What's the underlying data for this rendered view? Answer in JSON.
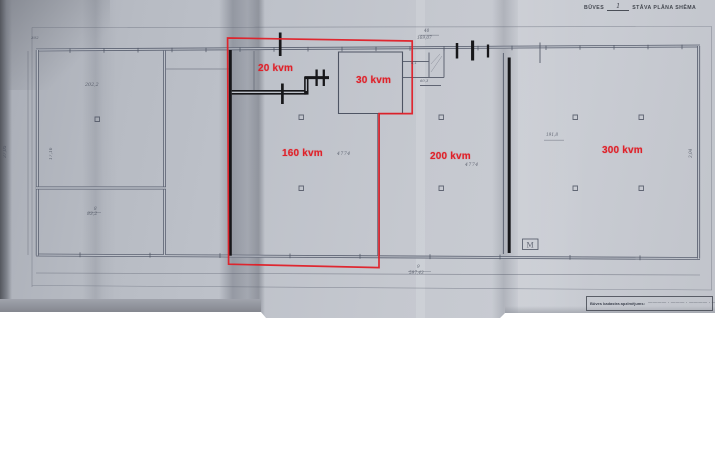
{
  "colors": {
    "paper": "#bdc1c9",
    "pencil": "#4e5463",
    "marker": "#17171a",
    "annotation_red": "#df2129"
  },
  "header_note": {
    "prefix": "BŪVES",
    "number": "1",
    "suffix": "STĀVA PLĀNA SHĒMA"
  },
  "room_labels": [
    {
      "id": "room-20",
      "text": "20 kvm"
    },
    {
      "id": "room-30",
      "text": "30 kvm"
    },
    {
      "id": "room-160",
      "text": "160 kvm"
    },
    {
      "id": "room-200",
      "text": "200 kvm"
    },
    {
      "id": "room-300",
      "text": "300 kvm"
    }
  ],
  "title_block": {
    "label": "Būves kadastra apzīmējums:",
    "value": "———— · ——— · ———— · ———"
  },
  "plan_marks": {
    "m_box": "M",
    "pencil_dimensions": {
      "d302": "302",
      "d2022": "202,2",
      "d8": "8",
      "d832": "83,2",
      "d4774a": "4774",
      "d4774b": "4774",
      "d40": "40",
      "d16907": "169,07",
      "d9": "9",
      "d59743": "597,43",
      "d1918": "191,8",
      "d3705": "37,05",
      "d1716": "17,16",
      "d41": "4,1",
      "d603": "60,3",
      "d304": "3,04"
    }
  }
}
